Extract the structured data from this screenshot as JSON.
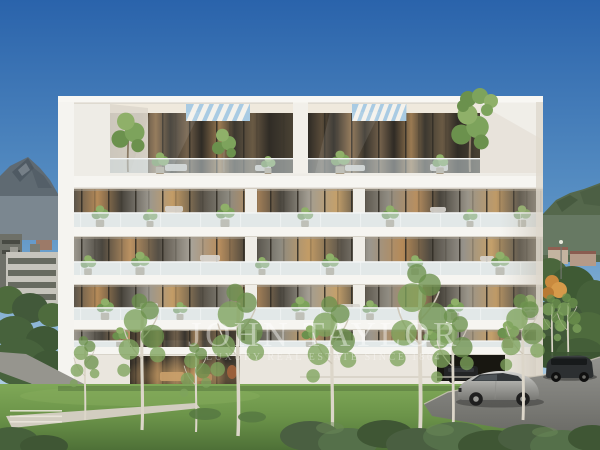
{
  "scene": {
    "description": "Architectural exterior rendering of a modern white apartment residence with glass balconies and planted terraces, alpine mountains behind, birch trees and lawn in front, driveway with parked cars at right"
  },
  "watermark": {
    "title": "JOHN TAYLOR",
    "subtitle": "LUXURY REAL ESTATE SINCE 1864"
  },
  "colors": {
    "sky_top": "#2a63ab",
    "sky_mid": "#5e95c6",
    "sky_horizon": "#c9deec",
    "mountain_left": "#5f6a72",
    "mountain_left_dark": "#49545d",
    "mountain_right": "#55684c",
    "mountain_right_dark": "#42543b",
    "facade": "#eeece6",
    "facade_bright": "#f8f7f3",
    "facade_shade": "#ddd6cb",
    "glass_warm": "#b98e5f",
    "glass_dark": "#3c372e",
    "balustrade_glass": "#d5e4e9",
    "lawn_light": "#7fa857",
    "lawn_dark": "#4e7037",
    "bush": "#4a5f41",
    "foliage": "#7da35c",
    "trunk": "#dcd6c9",
    "path": "#d2cdc0",
    "driveway_light": "#93938f",
    "driveway_dark": "#6b6b66",
    "garage": "#181711",
    "car_silver": "#a9a9a5",
    "car_dark": "#2c2f31"
  }
}
